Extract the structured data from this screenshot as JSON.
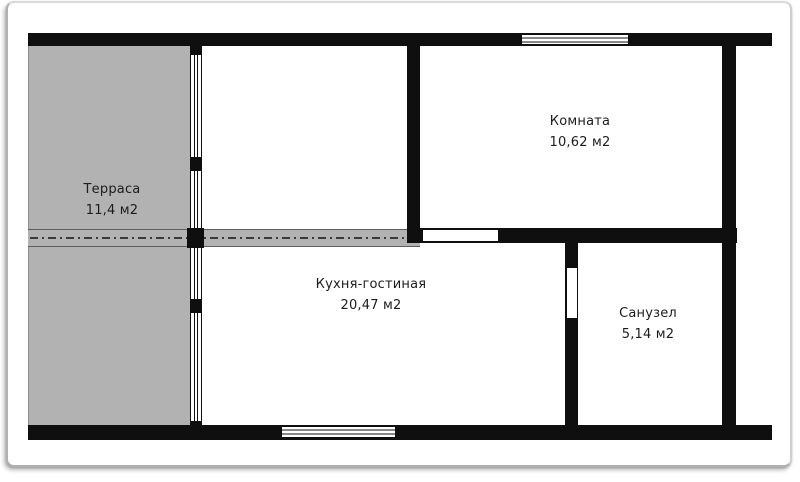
{
  "plan": {
    "rooms": [
      {
        "name": "Терраса",
        "area": "11,4 м2"
      },
      {
        "name": "Кухня-гостиная",
        "area": "20,47 м2"
      },
      {
        "name": "Комната",
        "area": "10,62 м2"
      },
      {
        "name": "Санузел",
        "area": "5,14 м2"
      }
    ]
  },
  "colors": {
    "wall": "#0f0f0f",
    "terrace_fill": "#b2b2b2",
    "band_fill": "#b2b2b2",
    "band_line": "#3a3a3a",
    "text": "#1c1c1c",
    "frame_border": "#b0b0b0"
  }
}
